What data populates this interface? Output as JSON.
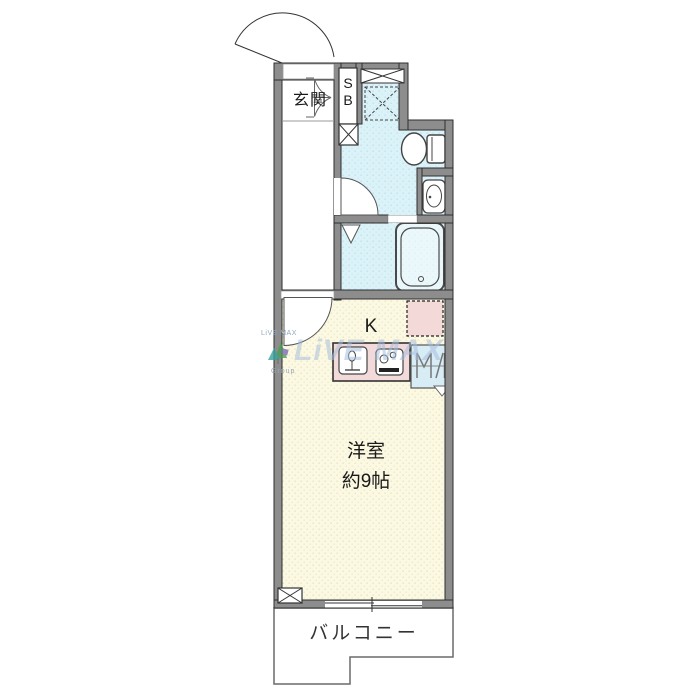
{
  "plan": {
    "rooms": {
      "entrance": {
        "label": "玄関"
      },
      "shoe_box": {
        "label": "S\nB"
      },
      "kitchen": {
        "label": "K"
      },
      "main_room": {
        "label": "洋室\n約9帖"
      },
      "balcony": {
        "label": "バルコニー"
      }
    },
    "watermark": {
      "brand_large": "LiVE MAX",
      "brand_small_top": "LiVE MAX",
      "brand_small_bottom": "Group"
    },
    "colors": {
      "wall": "#8d8d8d",
      "wet_area": "#d9f1f7",
      "room": "#fcf9e2",
      "counter": "#f2dada",
      "appliance_space": "#f4d9d9",
      "outline": "#333333",
      "watermark_blue": "#a5bedc"
    }
  }
}
